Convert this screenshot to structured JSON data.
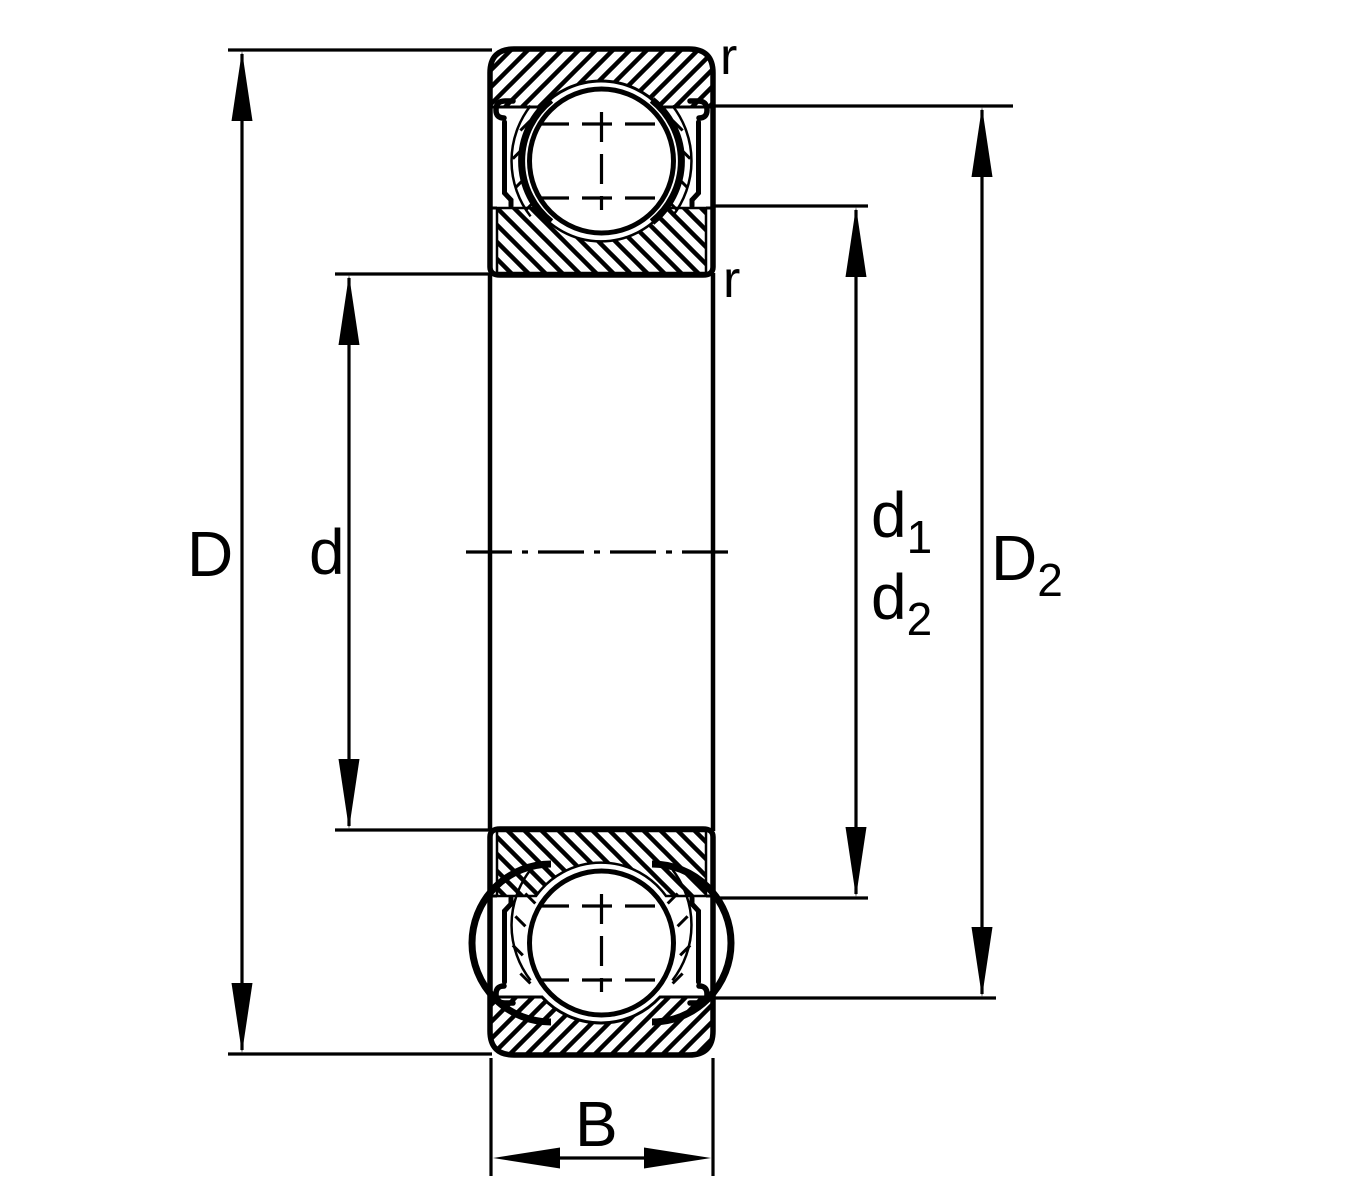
{
  "diagram": {
    "type": "bearing-cross-section-dimension-drawing",
    "subject": "deep groove ball bearing with shields, axial cross-section",
    "labels": {
      "outer_diameter": "D",
      "bore_diameter": "d",
      "d1": {
        "base": "d",
        "sub": "1"
      },
      "d2": {
        "base": "d",
        "sub": "2"
      },
      "D2": {
        "base": "D",
        "sub": "2"
      },
      "width": "B",
      "radius_outer": "r",
      "radius_inner": "r"
    },
    "colors": {
      "line": "#000000",
      "background": "#ffffff"
    }
  }
}
